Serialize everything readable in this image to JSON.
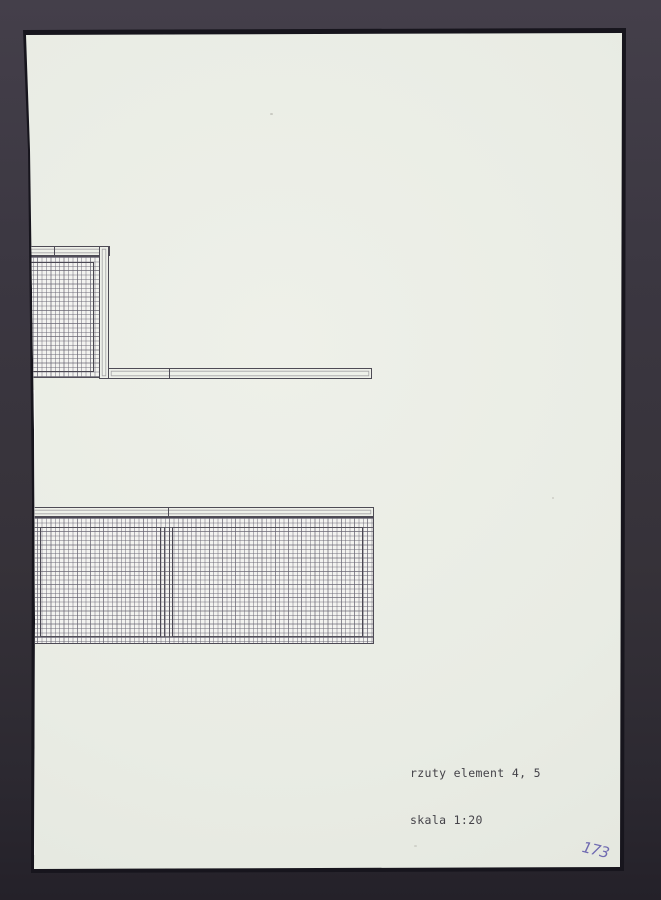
{
  "caption": {
    "line1": "rzuty element 4, 5",
    "line2": "skala 1:20"
  },
  "page_number": "173",
  "colors": {
    "background": "#38343f",
    "paper": "#e9ece4",
    "ink": "#4e4b55",
    "grid_line": "#8f8c98",
    "caption_ink": "#454349",
    "handwriting_blue": "#5b54a8"
  },
  "drawings": [
    {
      "name": "element-4-plan"
    },
    {
      "name": "element-5-plan"
    }
  ]
}
